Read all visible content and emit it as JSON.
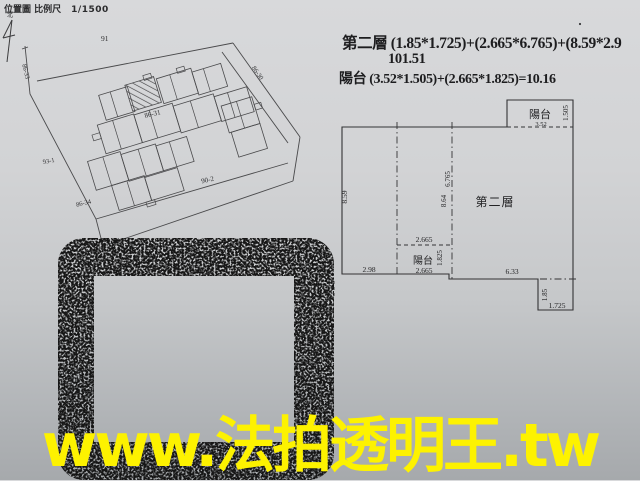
{
  "colors": {
    "paper_top": "#d8d9db",
    "paper_bottom": "#a6a9ac",
    "ink": "#2b2b2d",
    "drawing_line": "#4a4a4c",
    "stamp_ink": "#141414",
    "watermark_yellow": "#fdf200"
  },
  "header": {
    "title": "位置圖 比例尺",
    "scale": "1/1500",
    "north_label": "北"
  },
  "formulas": {
    "line1": "第二層 (1.85*1.725)+(2.665*6.765)+(8.59*2.9",
    "line2": "101.51",
    "line3": "陽台 (3.52*1.505)+(2.665*1.825)=10.16"
  },
  "site_plan": {
    "lot_91": "91",
    "lot_86_33": "86-33",
    "lot_86_30": "86-30",
    "lot_86_31": "86-31",
    "lot_93_1": "93-1",
    "lot_90_2": "90-2",
    "lot_86_34": "86-34"
  },
  "floor_plan": {
    "room": "第二層",
    "top_balcony": {
      "label": "陽台",
      "w": "3.52",
      "h": "1.505"
    },
    "inner_balcony": {
      "label": "陽台",
      "w_top": "2.665",
      "w_bottom": "2.665",
      "h": "1.825"
    },
    "dims": {
      "left_h": "8.59",
      "mid_h": "6.765",
      "right_h": "8.64",
      "bottom_left_w": "2.98",
      "bottom_right_w": "6.33",
      "notch_h": "1.85",
      "notch_w": "1.725"
    }
  },
  "watermark": {
    "text": "www.法拍透明王.tw"
  }
}
